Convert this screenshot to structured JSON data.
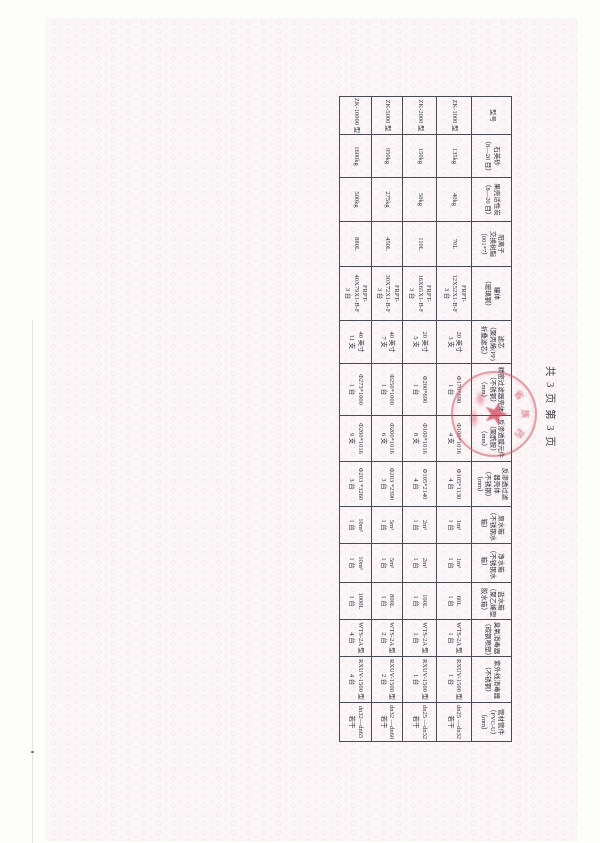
{
  "page": {
    "page_info": "共 3 页  第 3 页"
  },
  "table": {
    "headers": [
      "型号",
      "石英砂\n（8—20 目）",
      "果壳活性炭\n（8—20 目）",
      "阳离子\n交换树脂\n（001*7）",
      "罐体\n（玻璃钢）",
      "滤芯\n（聚丙烯(PP)\n折叠滤芯）",
      "精密过滤器壳体\n（不锈钢）\n（mm）",
      "反渗透膜元件\n（聚酰胺）\n（mm）",
      "反渗透过滤\n器壳体\n（不锈钢）\n（mm）",
      "原水箱\n（不锈钢水箱）",
      "净水箱\n（不锈钢水箱）",
      "盐水箱\n（聚乙烯塑\n胶水箱）",
      "臭氧消毒器\n（碳钢喷塑）",
      "紫外线消毒器\n（不锈钢）",
      "管材管件\n（PVC-U）\n（mm）"
    ],
    "rows": [
      [
        "ZK-1000 型",
        "135kg",
        "40kg",
        "70L",
        "FRPT-\n12X52X1-B-F\n3 台",
        "20 英寸\n3 支",
        "Φ170*690\n1 台",
        "Φ100*1016\n4 支",
        "Φ105*1130\n4 台",
        "1m³\n1 台",
        "1m³\n1 台",
        "60L\n1 台",
        "WTS-2A 型\n1 台",
        "RXUV-1500 型\n1 台",
        "dn25 —dn32\n若干"
      ],
      [
        "ZK-2000 型",
        "150kg",
        "50kg",
        "110L",
        "FRPT-\n16X65X1-B-F\n3 台",
        "20 英寸\n5 支",
        "Φ200*690\n1 台",
        "Φ100*1016\n8 支",
        "Φ105*2140\n4 台",
        "2m³\n1 台",
        "2m³\n1 台",
        "100L\n1 台",
        "WTS-2A 型\n1 台",
        "RXUV-1500 型\n1 台",
        "dn25 —dn32\n若干"
      ],
      [
        "ZK-5000 型",
        "950kg",
        "275kg",
        "450L",
        "FRPT-\n30X72X1-B-F\n3 台",
        "40 英寸\n7 支",
        "Φ250*1000\n1 台",
        "Φ200*1016\n6 支",
        "Φ203 *2390\n3 台",
        "5m³\n1 台",
        "5m³\n1 台",
        "800L\n1 台",
        "WTS-2A 型\n2 台",
        "RXUV-1500 型\n2 台",
        "dn32 —dn60\n若干"
      ],
      [
        "ZK-10000 型",
        "1600kg",
        "500kg",
        "880L",
        "FRPT-\n40X79X1-B-F\n3 台",
        "40 英寸\n11 支",
        "Φ273*1000\n1 台",
        "Φ200*1016\n9 支",
        "Φ203 *3260\n3 台",
        "10m³\n1 台",
        "10m³\n1 台",
        "1000L\n1 台",
        "WTS-2A 型\n4 台",
        "RXUV-1500 型\n4 台",
        "dn32—dn65\n若干"
      ]
    ]
  },
  "stamp": {
    "arc_chars": [
      "省",
      "族",
      "药"
    ],
    "star_glyph": "★",
    "color": "#d65264"
  }
}
